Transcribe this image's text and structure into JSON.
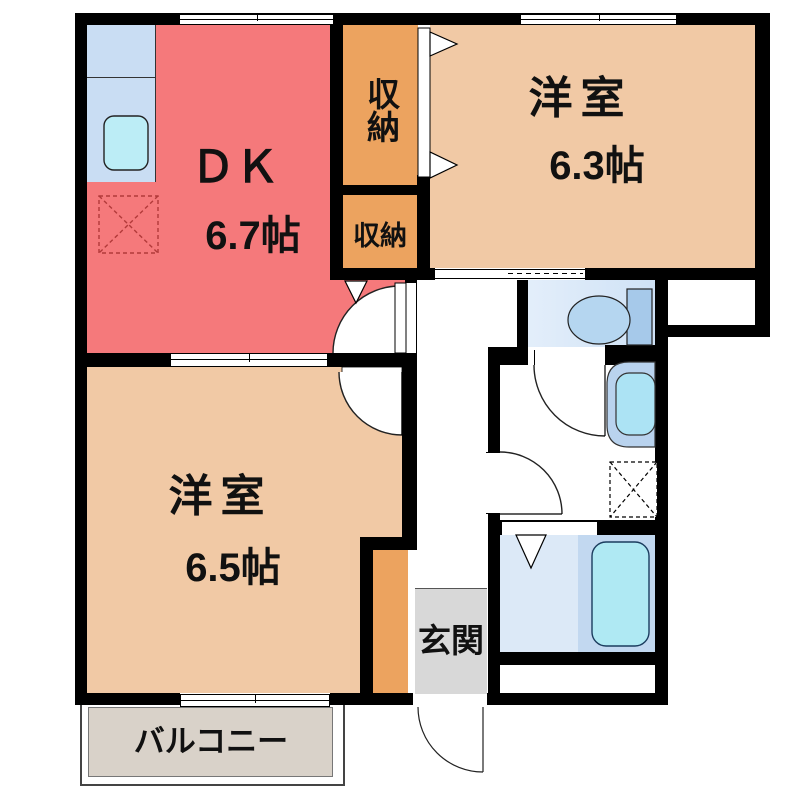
{
  "plan": {
    "title": "apartment-floor-plan",
    "rooms": {
      "dk": {
        "label": "ＤＫ",
        "area": "6.7帖"
      },
      "bedroom_right": {
        "label": "洋室",
        "area": "6.3帖"
      },
      "bedroom_left": {
        "label": "洋室",
        "area": "6.5帖"
      },
      "closet_top": {
        "label": "収納"
      },
      "closet_bottom": {
        "label": "収納"
      },
      "entrance": {
        "label": "玄関"
      },
      "balcony": {
        "label": "バルコニー"
      }
    },
    "fixtures": {
      "kitchen_sink": "kitchen-sink",
      "refrigerator_space": "refrigerator-space",
      "toilet": "toilet",
      "washbasin": "washbasin",
      "washing_machine_space": "washing-machine-space",
      "bathtub": "bathtub"
    },
    "colors": {
      "wall": "#000000",
      "dk_floor": "#F5797B",
      "bedroom_floor": "#F1C9A5",
      "closet": "#ECA35F",
      "kitchen_counter": "#C9DDF3",
      "sink": "#BCEDF6",
      "refrigerator_dash": "#B23A3A",
      "toilet_floor": "#D9E8F8",
      "toilet_fixture": "#A6C9EA",
      "washbasin": "#ACE3F4",
      "bath_floor_left": "#DCE9F7",
      "bath_floor_right": "#C2D8F0",
      "bathtub": "#AFE9F3",
      "entrance_floor": "#D8D8D8",
      "balcony_floor": "#D9D2C9"
    }
  }
}
